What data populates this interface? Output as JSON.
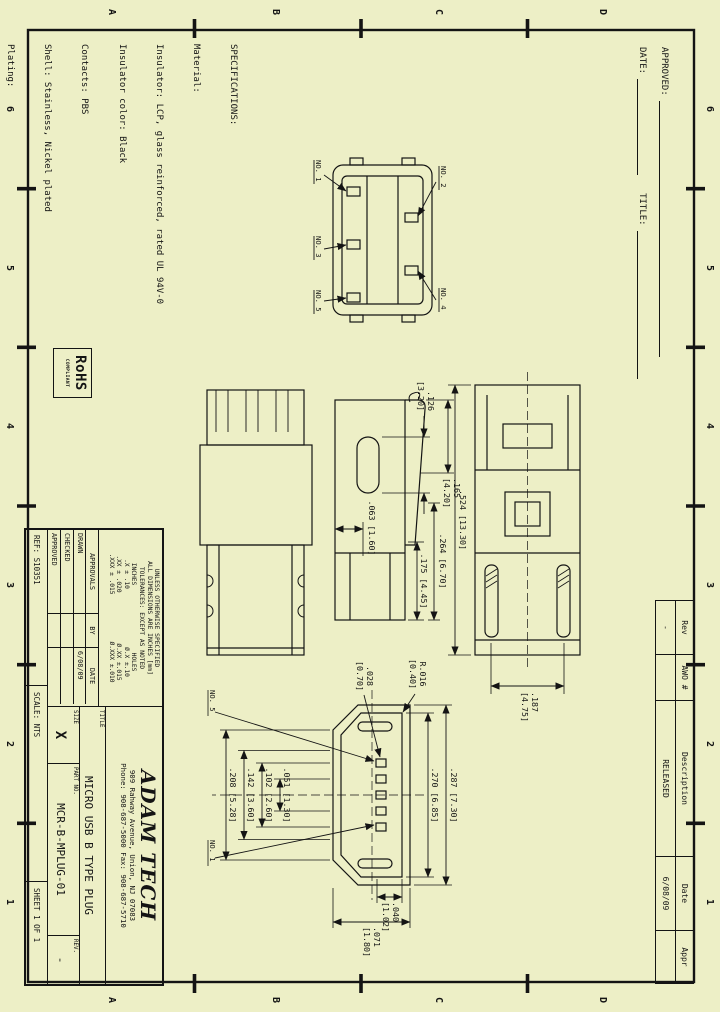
{
  "zones": {
    "numbers": [
      "6",
      "5",
      "4",
      "3",
      "2",
      "1"
    ],
    "letters": [
      "D",
      "C",
      "B",
      "A"
    ]
  },
  "approval_block": {
    "approved_label": "APPROVED:",
    "date_label": "DATE:",
    "title_label": "TITLE:"
  },
  "spec": {
    "lines": [
      "SPECIFICATIONS:",
      "Material:",
      "Insulator: LCP, glass reinforced, rated UL 94V-0",
      "Insulator color: Black",
      "Contacts: PBS",
      "Shell: Stainless, Nickel plated",
      "Plating:",
      "30u\" Gold over Nickel underplate overall",
      "Electrical:",
      "Current rating: 1 Amp max.",
      "Contact resistance: 30 mohms max.",
      "Insulation resistance: 100 Mohms min. @ 500 VDC",
      "Dielectric withstanding voltage: 100 VAC for 1 minute",
      "Temperature Rating:",
      "Operating temperature: -30°C to +80°C",
      "Environmental:",
      "Lead free, RoHS compliant.",
      "Recommended soldering temp: 260°C for 5 sec."
    ]
  },
  "rohs": {
    "line1": "RoHS",
    "line2": "COMPLIANT"
  },
  "rev_table": {
    "headers": [
      "Rev",
      "AWO #",
      "Description",
      "Date",
      "Appr"
    ],
    "row": [
      "-",
      "",
      "RELEASED",
      "6/08/09",
      ""
    ]
  },
  "title_block": {
    "tol_lines": {
      "l1": "UNLESS OTHERWISE SPECIFIED",
      "l2": "ALL DIMENSIONS ARE INCHES [mm]",
      "l3": "TOLERANCES: EXCEPT AS NOTED"
    },
    "tol_table": {
      "c1h": "INCHES",
      "c2h": "HOLES",
      "r1a": ".X ± .10",
      "r1b": "Ø.X ±.10",
      "r2a": ".XX ± .020",
      "r2b": "Ø.XX ±.015",
      "r3a": ".XXX ± .015",
      "r3b": "Ø.XXX ±.010"
    },
    "approvals": {
      "header": [
        "APPROVALS",
        "BY",
        "DATE"
      ],
      "rows": [
        [
          "DRAWN",
          "",
          "6/08/09"
        ],
        [
          "CHECKED",
          "",
          ""
        ],
        [
          "APPROVED",
          "",
          ""
        ]
      ]
    },
    "company": {
      "name": "ADAM TECH",
      "address": "909 Rahway Avenue, Union, NJ 07083",
      "phone": "Phone: 908-687-5000 Fax: 908-687-5710"
    },
    "title_label": "TITLE",
    "title_value": "MICRO USB B TYPE PLUG",
    "size_label": "SIZE",
    "size_value": "X",
    "part_label": "PART NO.",
    "part_value": "MCR-B-MPLUG-01",
    "rev_label": "REV.",
    "rev_value": "-",
    "ref": "REF:  S10351",
    "scale": "SCALE:  NTS",
    "sheet": "SHEET  1  OF  1"
  },
  "dims": {
    "d126": {
      "in": ".126",
      "mm": "[3.20]"
    },
    "d165": {
      "in": ".165",
      "mm": "[4.20]"
    },
    "d063": {
      "in": ".063",
      "mm": "[1.60]"
    },
    "d175": {
      "in": ".175",
      "mm": "[4.45]"
    },
    "d264": {
      "in": ".264",
      "mm": "[6.70]"
    },
    "d524": {
      "in": ".524",
      "mm": "[13.30]"
    },
    "d187": {
      "in": ".187",
      "mm": "[4.75]"
    },
    "d028": {
      "in": ".028",
      "mm": "[0.70]"
    },
    "r016": {
      "in": "R.016",
      "mm": "[0.40]"
    },
    "d287": {
      "in": ".287",
      "mm": "[7.30]"
    },
    "d270": {
      "in": ".270",
      "mm": "[6.85]"
    },
    "d051": {
      "in": ".051",
      "mm": "[1.30]"
    },
    "d102": {
      "in": ".102",
      "mm": "[2.60]"
    },
    "d142": {
      "in": ".142",
      "mm": "[3.60]"
    },
    "d208": {
      "in": ".208",
      "mm": "[5.28]"
    },
    "d071": {
      "in": ".071",
      "mm": "[1.80]"
    },
    "d040": {
      "in": ".040",
      "mm": "[1.02]"
    }
  },
  "pins": {
    "no1": "NO. 1",
    "no2": "NO. 2",
    "no3": "NO. 3",
    "no4": "NO. 4",
    "no5": "NO. 5"
  }
}
